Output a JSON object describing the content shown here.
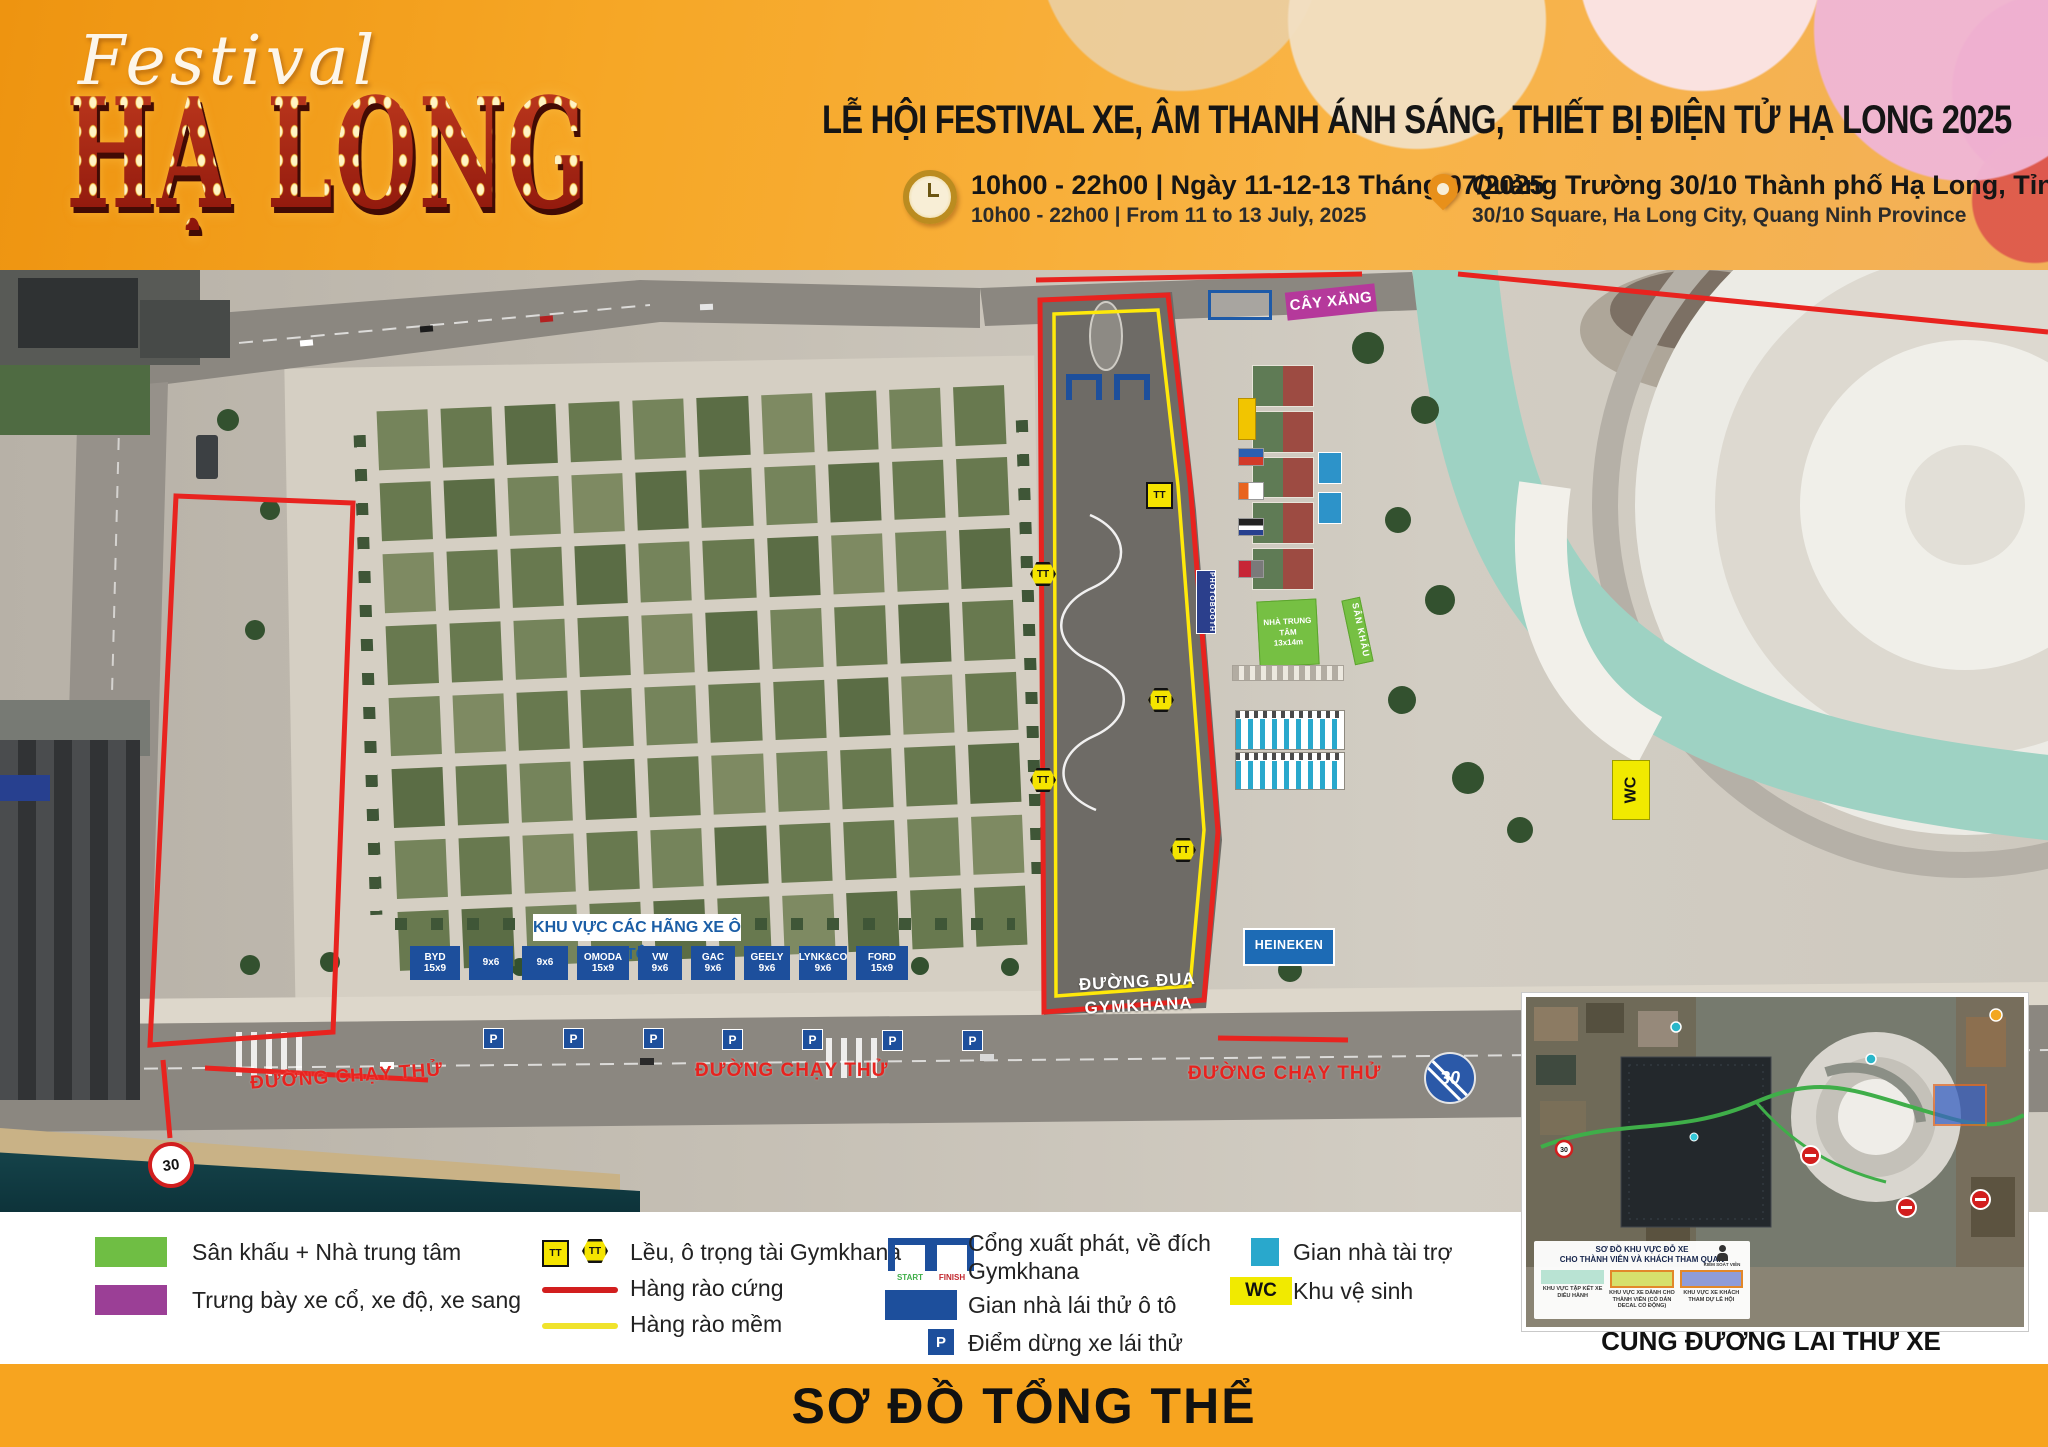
{
  "colors": {
    "accent_orange": "#f7a41f",
    "red": "#e8231f",
    "yellow": "#f5e400",
    "green": "#6fbe44",
    "purple": "#9b3f96",
    "blue": "#1d4f9c",
    "cyan": "#29a8cc",
    "magenta": "#b5399b"
  },
  "header": {
    "logo_script": "Festival",
    "logo_main": "HẠ LONG",
    "title": "LỄ HỘI FESTIVAL XE, ÂM THANH ÁNH SÁNG, THIẾT BỊ ĐIỆN TỬ HẠ LONG 2025",
    "time_vi": "10h00 - 22h00 | Ngày 11-12-13 Tháng 07/2025",
    "time_en": "10h00 - 22h00 | From 11 to 13 July, 2025",
    "location_vi": "Quảng Trường 30/10 Thành phố Hạ Long, Tỉnh Quảng Ninh",
    "location_en": "30/10 Square, Ha Long City, Quang Ninh Province"
  },
  "map": {
    "gas_station": "CÂY XĂNG",
    "photobooth": "PHOTOBOOTH",
    "central_house_line1": "NHÀ TRUNG TÂM",
    "central_house_line2": "13x14m",
    "stage": "SÂN KHẤU",
    "heineken": "HEINEKEN",
    "wc": "WC",
    "track_line1": "ĐƯỜNG ĐUA",
    "track_line2": "GYMKHANA",
    "car_zone_title": "KHU VỰC CÁC HÃNG XE Ô TÔ",
    "test_road": "ĐƯỜNG CHẠY THỬ",
    "speed_limit": "30",
    "tt": "TT",
    "p": "P",
    "car_brands": [
      {
        "name": "BYD",
        "size": "15x9"
      },
      {
        "name": "",
        "size": "9x6"
      },
      {
        "name": "",
        "size": "9x6"
      },
      {
        "name": "OMODA",
        "size": "15x9"
      },
      {
        "name": "VW",
        "size": "9x6"
      },
      {
        "name": "GAC",
        "size": "9x6"
      },
      {
        "name": "GEELY",
        "size": "9x6"
      },
      {
        "name": "LYNK&CO",
        "size": "9x6"
      },
      {
        "name": "FORD",
        "size": "15x9"
      }
    ]
  },
  "legend": {
    "stage_house": "Sân khấu + Nhà trung tâm",
    "classic_cars": "Trưng bày xe cổ, xe độ, xe sang",
    "referee_tent": "Lều, ô trọng tài Gymkhana",
    "hard_fence": "Hàng rào cứng",
    "soft_fence": "Hàng rào mềm",
    "gates_line1": "Cổng xuất phát, về đích",
    "gates_line2": "Gymkhana",
    "start": "START",
    "finish": "FINISH",
    "test_drive_house": "Gian nhà lái thử ô tô",
    "stop_point": "Điểm dừng xe lái thử",
    "sponsor_house": "Gian nhà tài trợ",
    "toilet": "Khu vệ sinh",
    "wc": "WC",
    "tt": "TT",
    "p": "P"
  },
  "inset": {
    "caption": "CUNG ĐƯỜNG LÁI THỬ XE",
    "box_title_line1": "SƠ ĐỒ KHU VỰC ĐỖ XE",
    "box_title_line2": "CHO THÀNH VIÊN VÀ KHÁCH THAM QUAN",
    "controller": "KIỂM SOÁT VIÊN",
    "zone1": "KHU VỰC TẬP KẾT XE DIỄU HÀNH",
    "zone2": "KHU VỰC XE DÀNH CHO THÀNH VIÊN (CÓ DÁN DECAL CỔ ĐỘNG)",
    "zone3": "KHU VỰC XE KHÁCH THAM DỰ LỄ HỘI",
    "speed_limit": "30"
  },
  "footer": {
    "title": "SƠ ĐỒ TỔNG THỂ"
  }
}
